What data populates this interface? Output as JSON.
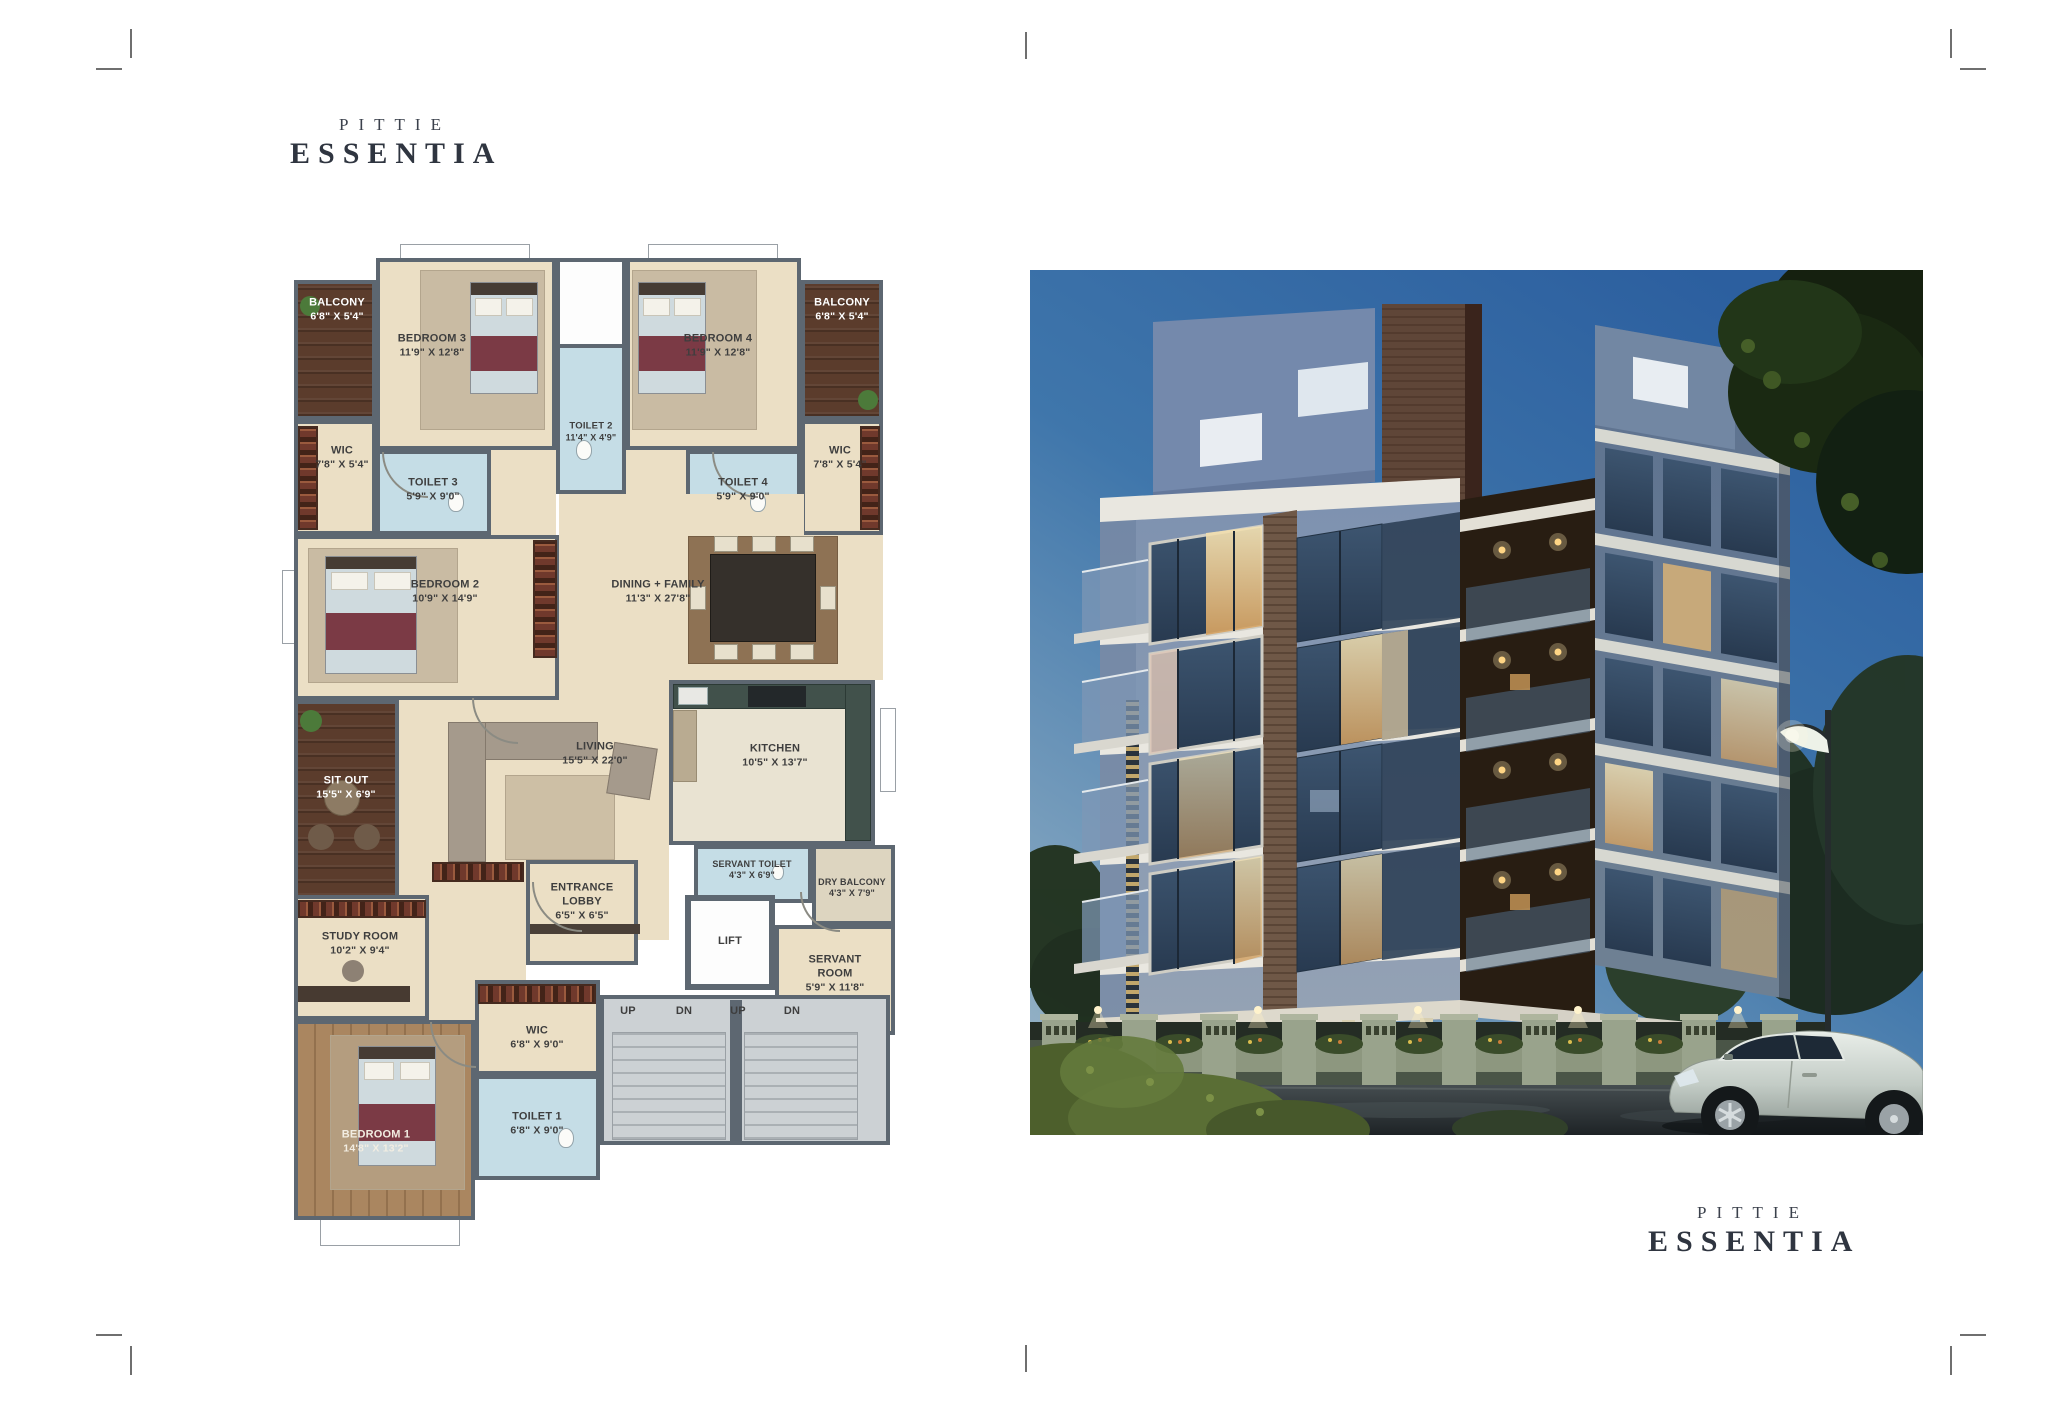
{
  "brand": {
    "line1": "PITTIE",
    "line2": "ESSENTIA",
    "color": "#2f3540"
  },
  "floor_plan": {
    "rooms": [
      {
        "name": "BALCONY",
        "dims": "6'8\" X 5'4\""
      },
      {
        "name": "BEDROOM 3",
        "dims": "11'9\" X 12'8\""
      },
      {
        "name": "TOILET 2",
        "dims": "11'4\" X 4'9\""
      },
      {
        "name": "BEDROOM 4",
        "dims": "11'9\" X 12'8\""
      },
      {
        "name": "BALCONY",
        "dims": "6'8\" X 5'4\""
      },
      {
        "name": "WIC",
        "dims": "7'8\" X 5'4\""
      },
      {
        "name": "TOILET 3",
        "dims": "5'9\" X 9'0\""
      },
      {
        "name": "TOILET 4",
        "dims": "5'9\" X 9'0\""
      },
      {
        "name": "WIC",
        "dims": "7'8\" X 5'4\""
      },
      {
        "name": "BEDROOM 2",
        "dims": "10'9\" X 14'9\""
      },
      {
        "name": "DINING + FAMILY",
        "dims": "11'3\" X 27'8\""
      },
      {
        "name": "SIT OUT",
        "dims": "15'5\" X 6'9\""
      },
      {
        "name": "LIVING",
        "dims": "15'5\" X 22'0\""
      },
      {
        "name": "KITCHEN",
        "dims": "10'5\" X 13'7\""
      },
      {
        "name": "SERVANT TOILET",
        "dims": "4'3\" X 6'9\""
      },
      {
        "name": "DRY BALCONY",
        "dims": "4'3\" X 7'9\""
      },
      {
        "name": "ENTRANCE LOBBY",
        "dims": "6'5\" X 6'5\""
      },
      {
        "name": "LIFT",
        "dims": ""
      },
      {
        "name": "SERVANT ROOM",
        "dims": "5'9\" X 11'8\""
      },
      {
        "name": "STUDY ROOM",
        "dims": "10'2\" X 9'4\""
      },
      {
        "name": "WIC",
        "dims": "6'8\" X 9'0\""
      },
      {
        "name": "TOILET 1",
        "dims": "6'8\" X 9'0\""
      },
      {
        "name": "BEDROOM 1",
        "dims": "14'8\" X 13'2\""
      }
    ],
    "stair_labels": [
      "UP",
      "DN",
      "UP",
      "DN"
    ],
    "colors": {
      "wall": "#5d6771",
      "floor": "#ebdfc5",
      "toilet": "#c5dde6",
      "deck": "#5b3c2c",
      "stairs": "#ccd1d4",
      "wood_floor": "#aa8660",
      "wardrobe": "#70392c"
    }
  },
  "photo_colors": {
    "sky_top": "#2c5f9f",
    "sky_bottom": "#98b4c6",
    "facade": "#8094b2",
    "facade_dark": "#5f7490",
    "lit_window": "#e3c287",
    "trees": "#1a2912",
    "street": "#2b3134",
    "car": "#cdd4cf",
    "fence": "#9aa38c"
  }
}
